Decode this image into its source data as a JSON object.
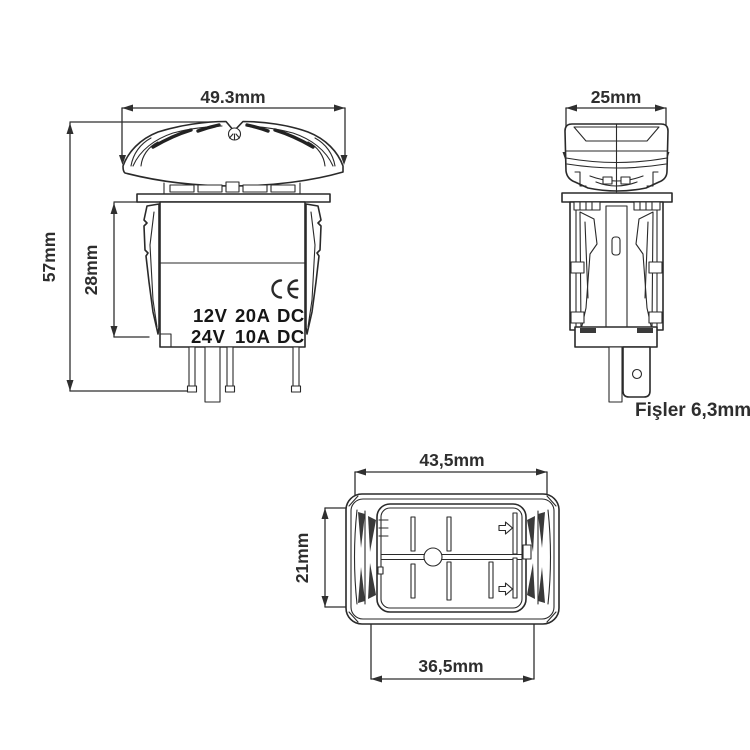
{
  "drawing": {
    "background": "#ffffff",
    "line_color": "#2a2a2a",
    "label_color": "#2e2e2e",
    "views": {
      "front": {
        "name": "front-view",
        "dim_width": "49.3mm",
        "dim_total_height": "57mm",
        "dim_body_height": "28mm",
        "ce_mark": "CE",
        "ratings": [
          [
            "12V",
            "20A",
            "DC"
          ],
          [
            "24V",
            "10A",
            "DC"
          ]
        ]
      },
      "side": {
        "name": "side-view",
        "dim_width": "25mm",
        "terminal_note": "Fişler 6,3mm"
      },
      "bottom": {
        "name": "bottom-view",
        "dim_outer_width": "43,5mm",
        "dim_height": "21mm",
        "dim_inner_width": "36,5mm"
      }
    }
  }
}
